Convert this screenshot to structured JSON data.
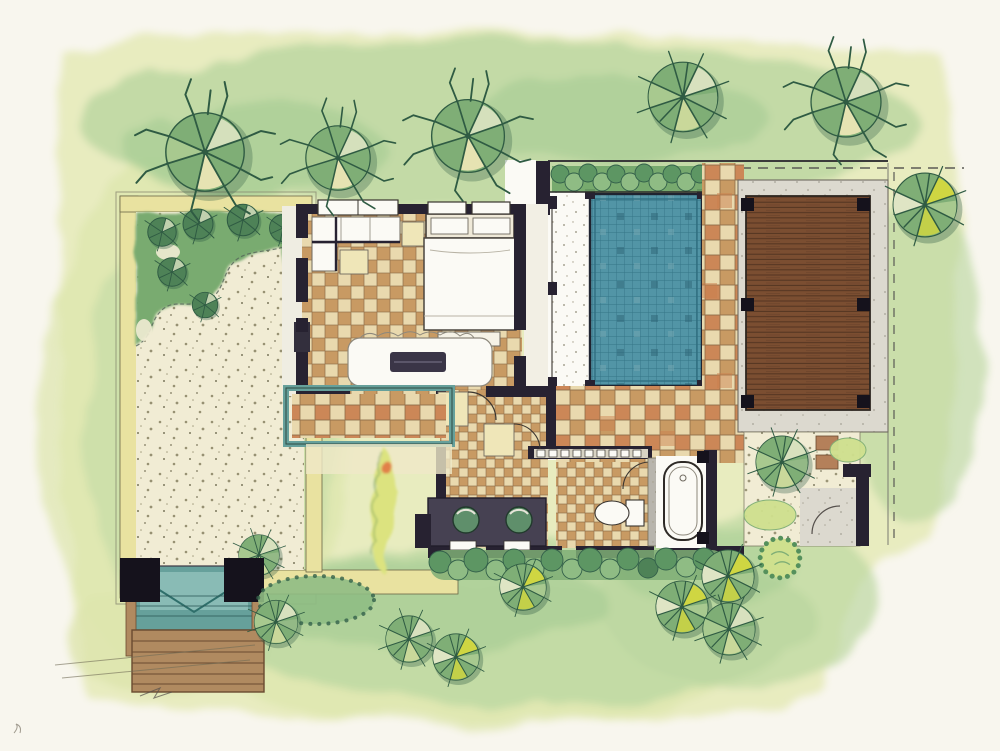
{
  "illustration": {
    "label": "Hand-drawn watercolor site plan of a pool villa with gravel courtyard, bedroom suite, swimming pool and timber sun deck",
    "style": "top-down watercolor floor plan sketch",
    "visible_text": ""
  },
  "palette": {
    "paper": "#f8f6ee",
    "wash_light": "#e7ebbd",
    "wash_mid": "#dde5ad",
    "wash_green": "#bcd7a1",
    "wash_deep": "#a3cb92",
    "tree_dark": "#2f5b43",
    "tree_mid": "#7fae76",
    "tree_light": "#a8c98f",
    "tree_pale": "#dfe5c4",
    "tree_yellow": "#d4d83f",
    "hedge_dark": "#33604a",
    "hedge_mid": "#5d9663",
    "hedge_light": "#8fbc84",
    "gravel": "#f1ecd4",
    "speckle": "#8d8768",
    "yellow_wall": "#e9e2a0",
    "wall": "#272231",
    "tile_tan": "#c89a63",
    "tile_cream": "#e9d9ae",
    "tile_warm": "#c97f4e",
    "tile_line": "#8a6a46",
    "pool_water": "#5295a6",
    "pool_grid": "#2f6f80",
    "deck_wood": "#7b4e31",
    "deck_line": "#523320",
    "stone": "#dcd9cf",
    "white": "#fbfaf5",
    "teal_water": "#66a09b",
    "teal_deep": "#2f6f6b",
    "basin": "#5f8f6b",
    "vanity": "#464152",
    "step_wood": "#b08a60",
    "step_line": "#6a4a30",
    "ink": "#3c3744"
  },
  "features": [
    {
      "name": "left-courtyard",
      "description": "walled gravel courtyard with planted corner of round shrubs"
    },
    {
      "name": "entry-gate",
      "description": "two black gate posts with teal water-step entry and timber stairs"
    },
    {
      "name": "bedroom",
      "description": "checker-tiled bedroom with king bed, pillows, built-in sofa and writing desk"
    },
    {
      "name": "timber-walkway",
      "description": "teal-edged timber walkway into the courtyard"
    },
    {
      "name": "dressing-hall",
      "description": "hall with wardrobe hanger row and cabinets"
    },
    {
      "name": "double-vanity",
      "description": "dark vanity counter with two round green basins"
    },
    {
      "name": "toilet-room",
      "description": "small tiled WC with toilet and swing door"
    },
    {
      "name": "bathtub-room",
      "description": "white bath room with oval tub and corner posts"
    },
    {
      "name": "swimming-pool",
      "description": "blue mosaic-tiled pool with terrazzo edge and hedge at its head"
    },
    {
      "name": "tile-path",
      "description": "tan checkerboard tile paths around pool and bath wing"
    },
    {
      "name": "sun-deck",
      "description": "brown timber plank deck with six black posts on a stone surround"
    },
    {
      "name": "side-garden-court",
      "description": "gravel court with round tree, stepping stones and arc gate"
    },
    {
      "name": "boundary-line",
      "description": "dashed property boundary at top right"
    },
    {
      "name": "garden-trees",
      "description": "sketched pinwheel watercolor trees and scalloped shrubs on lawn washes"
    }
  ]
}
